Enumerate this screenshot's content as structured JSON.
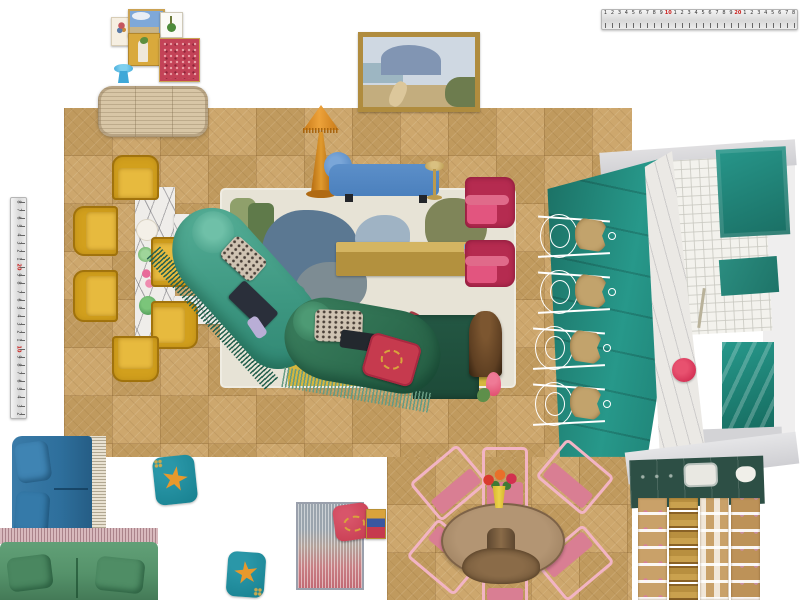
{
  "canvas": {
    "width": 800,
    "height": 600,
    "background": "#ffffff"
  },
  "palette": {
    "floor": "#cda76d",
    "floorDark": "#c09a5e",
    "rugBase": "#e7e3d6",
    "rugSage": "#8fa06b",
    "rugGreenDark": "#5f7a4a",
    "rugBlue": "#5b7892",
    "rugGrey": "#7d8c93",
    "rugOlive": "#7f8559",
    "rugPink": "#d88a98",
    "rugYellow": "#d5b73e",
    "rugRed": "#a43a44",
    "mustard": "#d2a01d",
    "marble": "#efedea",
    "tealChaise": "#46a38c",
    "tealFringe": "#25614f",
    "greenChaise": "#2e6e50",
    "greenFringe": "#679b82",
    "blueChaise": "#4b80bd",
    "lampOrange": "#df8a1e",
    "brass": "#bb9a4e",
    "pinkChair": "#b52b50",
    "pinkChairLight": "#e2557f",
    "kitchenTeal": "#1e7c6f",
    "greyCounter": "#d6d5d7",
    "blueSofa": "#2e6f9c",
    "creamFringe": "#e9e2d2",
    "greenSofa": "#55926a",
    "pinkFringe": "#d8b9bd",
    "cushionTeal": "#17808f",
    "starfish": "#e8992c",
    "redCushion": "#c63a4e",
    "gold": "#d9a33c",
    "pinkDine": "#f2b4c4",
    "pinkDineSeat": "#d97e93",
    "woodTable": "#a3866a",
    "planGreen": "#2d4f45",
    "planWood": "#c9a169",
    "stoolSeat": "#c2a36c",
    "blueStool": "#3fa8d8",
    "rattan": "#d8c6a6",
    "burl": "#5e3f22",
    "tulip": "#e0486a"
  },
  "rulers": {
    "horizontal": {
      "numbers": [
        "1",
        "2",
        "3",
        "4",
        "5",
        "6",
        "7",
        "8",
        "9",
        "10",
        "1",
        "2",
        "3",
        "4",
        "5",
        "6",
        "7",
        "8",
        "9",
        "20",
        "1",
        "2",
        "3",
        "4",
        "5",
        "6",
        "7",
        "8"
      ],
      "red_numbers": [
        "10",
        "20"
      ]
    },
    "vertical": {
      "numbers": [
        "8",
        "7",
        "6",
        "5",
        "4",
        "3",
        "2",
        "1",
        "20",
        "9",
        "8",
        "7",
        "6",
        "5",
        "4",
        "3",
        "2",
        "1",
        "10",
        "9",
        "8",
        "7",
        "6",
        "5",
        "4",
        "3",
        "2"
      ],
      "red_numbers": [
        "20",
        "10"
      ]
    }
  },
  "items": [
    {
      "name": "horizontal-tape-measure"
    },
    {
      "name": "vertical-tape-measure"
    },
    {
      "name": "botanical-print"
    },
    {
      "name": "sky-landscape-print"
    },
    {
      "name": "green-still-life-print"
    },
    {
      "name": "gold-figure-artwork"
    },
    {
      "name": "red-pattern-artwork"
    },
    {
      "name": "blue-side-stool",
      "color": "#3fa8d8"
    },
    {
      "name": "rattan-sideboard",
      "color": "#d8c6a6"
    },
    {
      "name": "coastal-landscape-painting",
      "frame": "#b08c3e"
    },
    {
      "name": "marble-dining-table",
      "color": "#efedea"
    },
    {
      "name": "mustard-tub-chair",
      "count": 6,
      "color": "#d2a01d"
    },
    {
      "name": "abstract-floral-area-rug",
      "color": "#e7e3d6"
    },
    {
      "name": "orange-floor-lamp",
      "color": "#df8a1e"
    },
    {
      "name": "blue-chaise-lounge",
      "color": "#4b80bd"
    },
    {
      "name": "brass-side-table",
      "color": "#bb9a4e"
    },
    {
      "name": "brass-coffee-table",
      "color": "#bb9a4e"
    },
    {
      "name": "teal-fringed-chaise",
      "color": "#46a38c"
    },
    {
      "name": "green-fringed-chaise",
      "color": "#2e6e50"
    },
    {
      "name": "leopard-cushion",
      "count": 2
    },
    {
      "name": "red-gold-cushion",
      "color": "#c63a4e"
    },
    {
      "name": "green-ottoman",
      "color": "#1d4a38"
    },
    {
      "name": "burl-drinks-cabinet",
      "color": "#5e3f22"
    },
    {
      "name": "pink-tulip-decor",
      "color": "#e0486a"
    },
    {
      "name": "magenta-armchair",
      "count": 2,
      "color": "#b52b50"
    },
    {
      "name": "teal-kitchen-photo",
      "color": "#1e7c6f"
    },
    {
      "name": "wire-bar-stool",
      "count": 4
    },
    {
      "name": "kitchen-plan-top-view"
    },
    {
      "name": "round-pedestal-dining-table",
      "color": "#a3866a"
    },
    {
      "name": "pink-metal-dining-chair",
      "count": 6,
      "color": "#f2b4c4"
    },
    {
      "name": "flower-vase",
      "color": "#e8c832"
    },
    {
      "name": "blue-fringed-sofa",
      "color": "#2e6f9c"
    },
    {
      "name": "green-fringed-sofa",
      "color": "#55926a"
    },
    {
      "name": "starfish-cushion",
      "count": 2,
      "color": "#17808f"
    },
    {
      "name": "gradient-textured-rug"
    },
    {
      "name": "red-tiger-cushion",
      "color": "#c63a4e"
    },
    {
      "name": "mini-artwork"
    }
  ]
}
